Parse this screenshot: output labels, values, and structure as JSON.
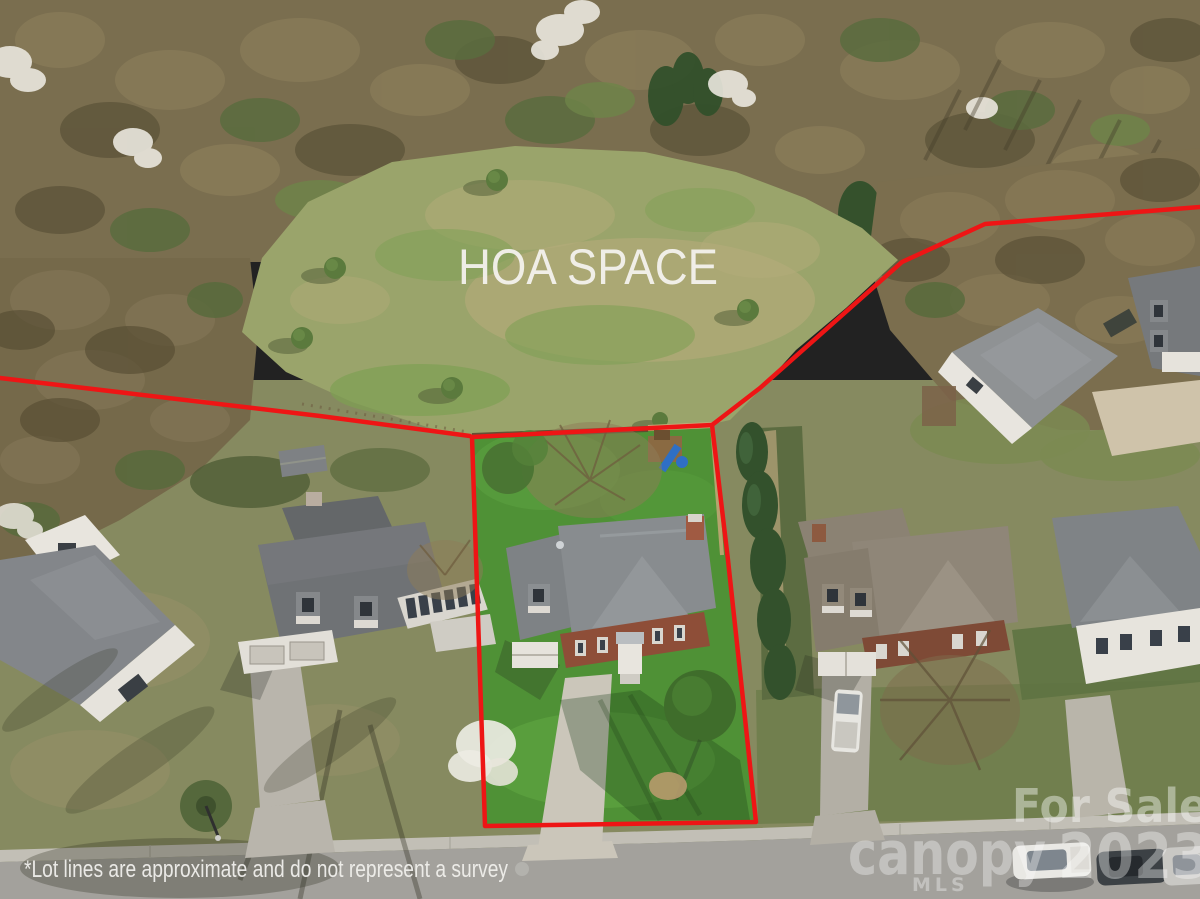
{
  "overlay": {
    "hoa_label": "HOA SPACE",
    "disclaimer": "*Lot lines are approximate and do not represent a survey"
  },
  "watermark": {
    "for_sale": "For Sale",
    "brand": "canopy",
    "brand_sub": "MLS",
    "year": "2023"
  },
  "colors": {
    "lot_line": "#ee1515",
    "overlay_text": "#f3f1ec",
    "watermark": "#ffffff"
  }
}
